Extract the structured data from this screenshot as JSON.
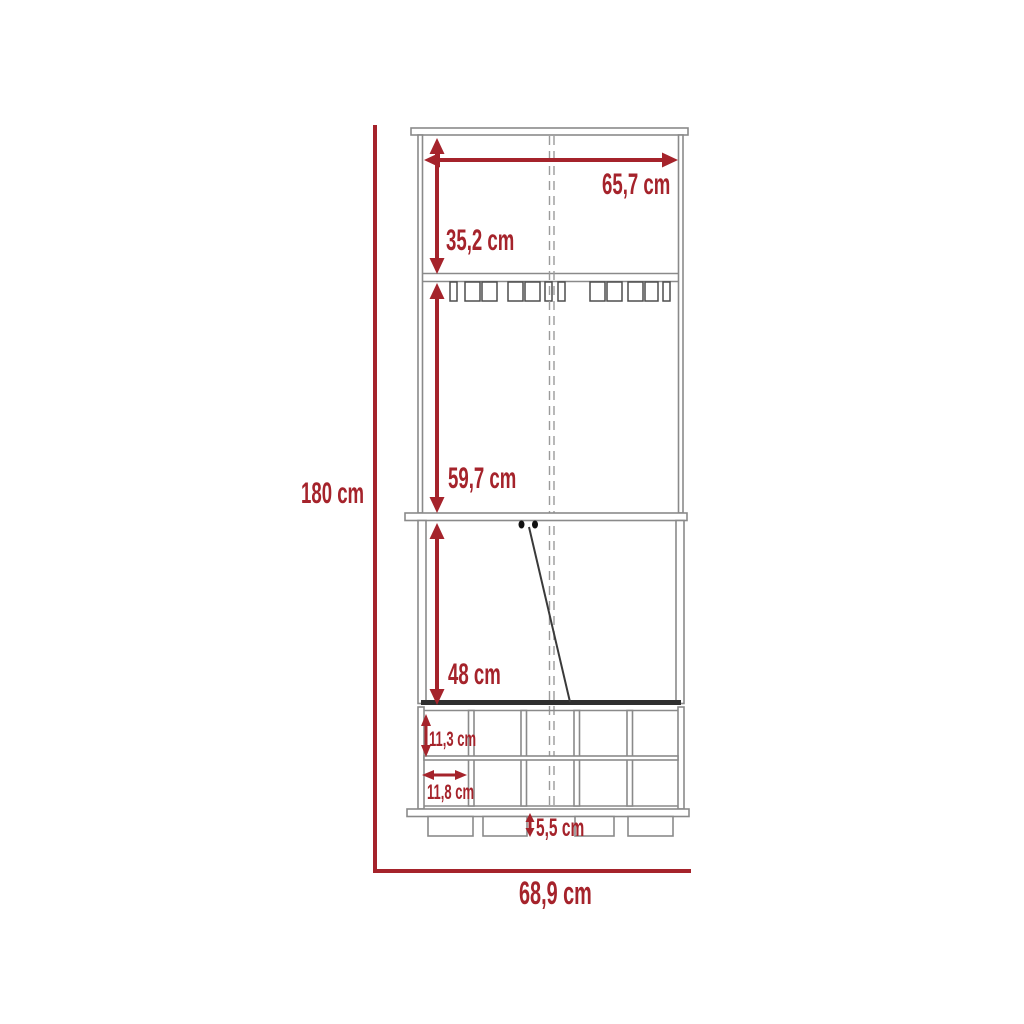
{
  "diagram": {
    "type": "furniture-dimension-drawing",
    "view": "front",
    "unit": "cm",
    "labels": {
      "total_height": "180 cm",
      "total_width": "68,9 cm",
      "top_width": "65,7 cm",
      "upper_section_height": "35,2 cm",
      "middle_section_height": "59,7 cm",
      "door_section_height": "48 cm",
      "bottle_slot_height": "11,3 cm",
      "bottle_slot_width": "11,8 cm",
      "leg_height": "5,5 cm"
    },
    "colors": {
      "dimension_red": "#a5232b",
      "line_gray": "#8a8a8a",
      "line_dark": "#2f2f2f",
      "background": "#ffffff"
    }
  }
}
